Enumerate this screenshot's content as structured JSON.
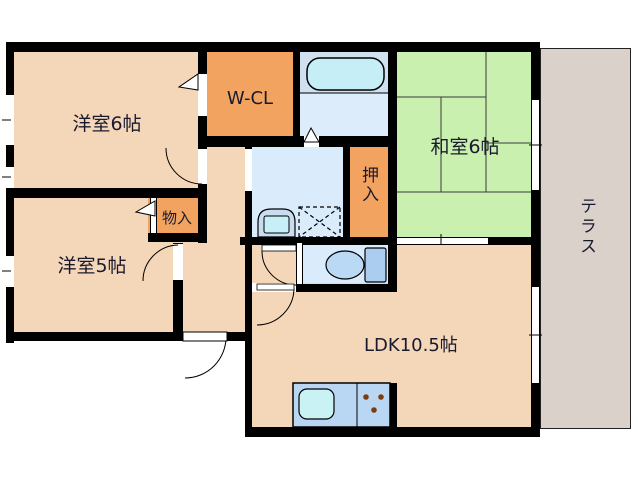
{
  "plan_title": "2LDK apartment floor plan",
  "rooms": {
    "western6": {
      "label": "洋室6帖"
    },
    "wcl": {
      "label": "W-CL"
    },
    "japanese6": {
      "label": "和室6帖"
    },
    "oshiire": {
      "label": "押入"
    },
    "monoire": {
      "label": "物入"
    },
    "western5": {
      "label": "洋室5帖"
    },
    "ldk": {
      "label": "LDK10.5帖"
    },
    "terrace": {
      "label": "テラス"
    }
  },
  "colors": {
    "wall": "#000000",
    "text": "#1a1a2e",
    "beige": "#f4d6b8",
    "orange": "#f2a35f",
    "green": "#c9f0ae",
    "blue_room": "#daecfb",
    "bath_upper": "#cfe1f1",
    "bath_lower": "#dcecfa",
    "tub": "#c6eef6",
    "counter": "#b9d7f2",
    "sink": "#c9f2f4",
    "terrace": "#d9d1ca",
    "tank": "#aacdf0",
    "bowl": "#bad9f5",
    "basin": "#c9dcf0",
    "basin_inner": "#c6eff8",
    "burner": "#7a3c10"
  }
}
